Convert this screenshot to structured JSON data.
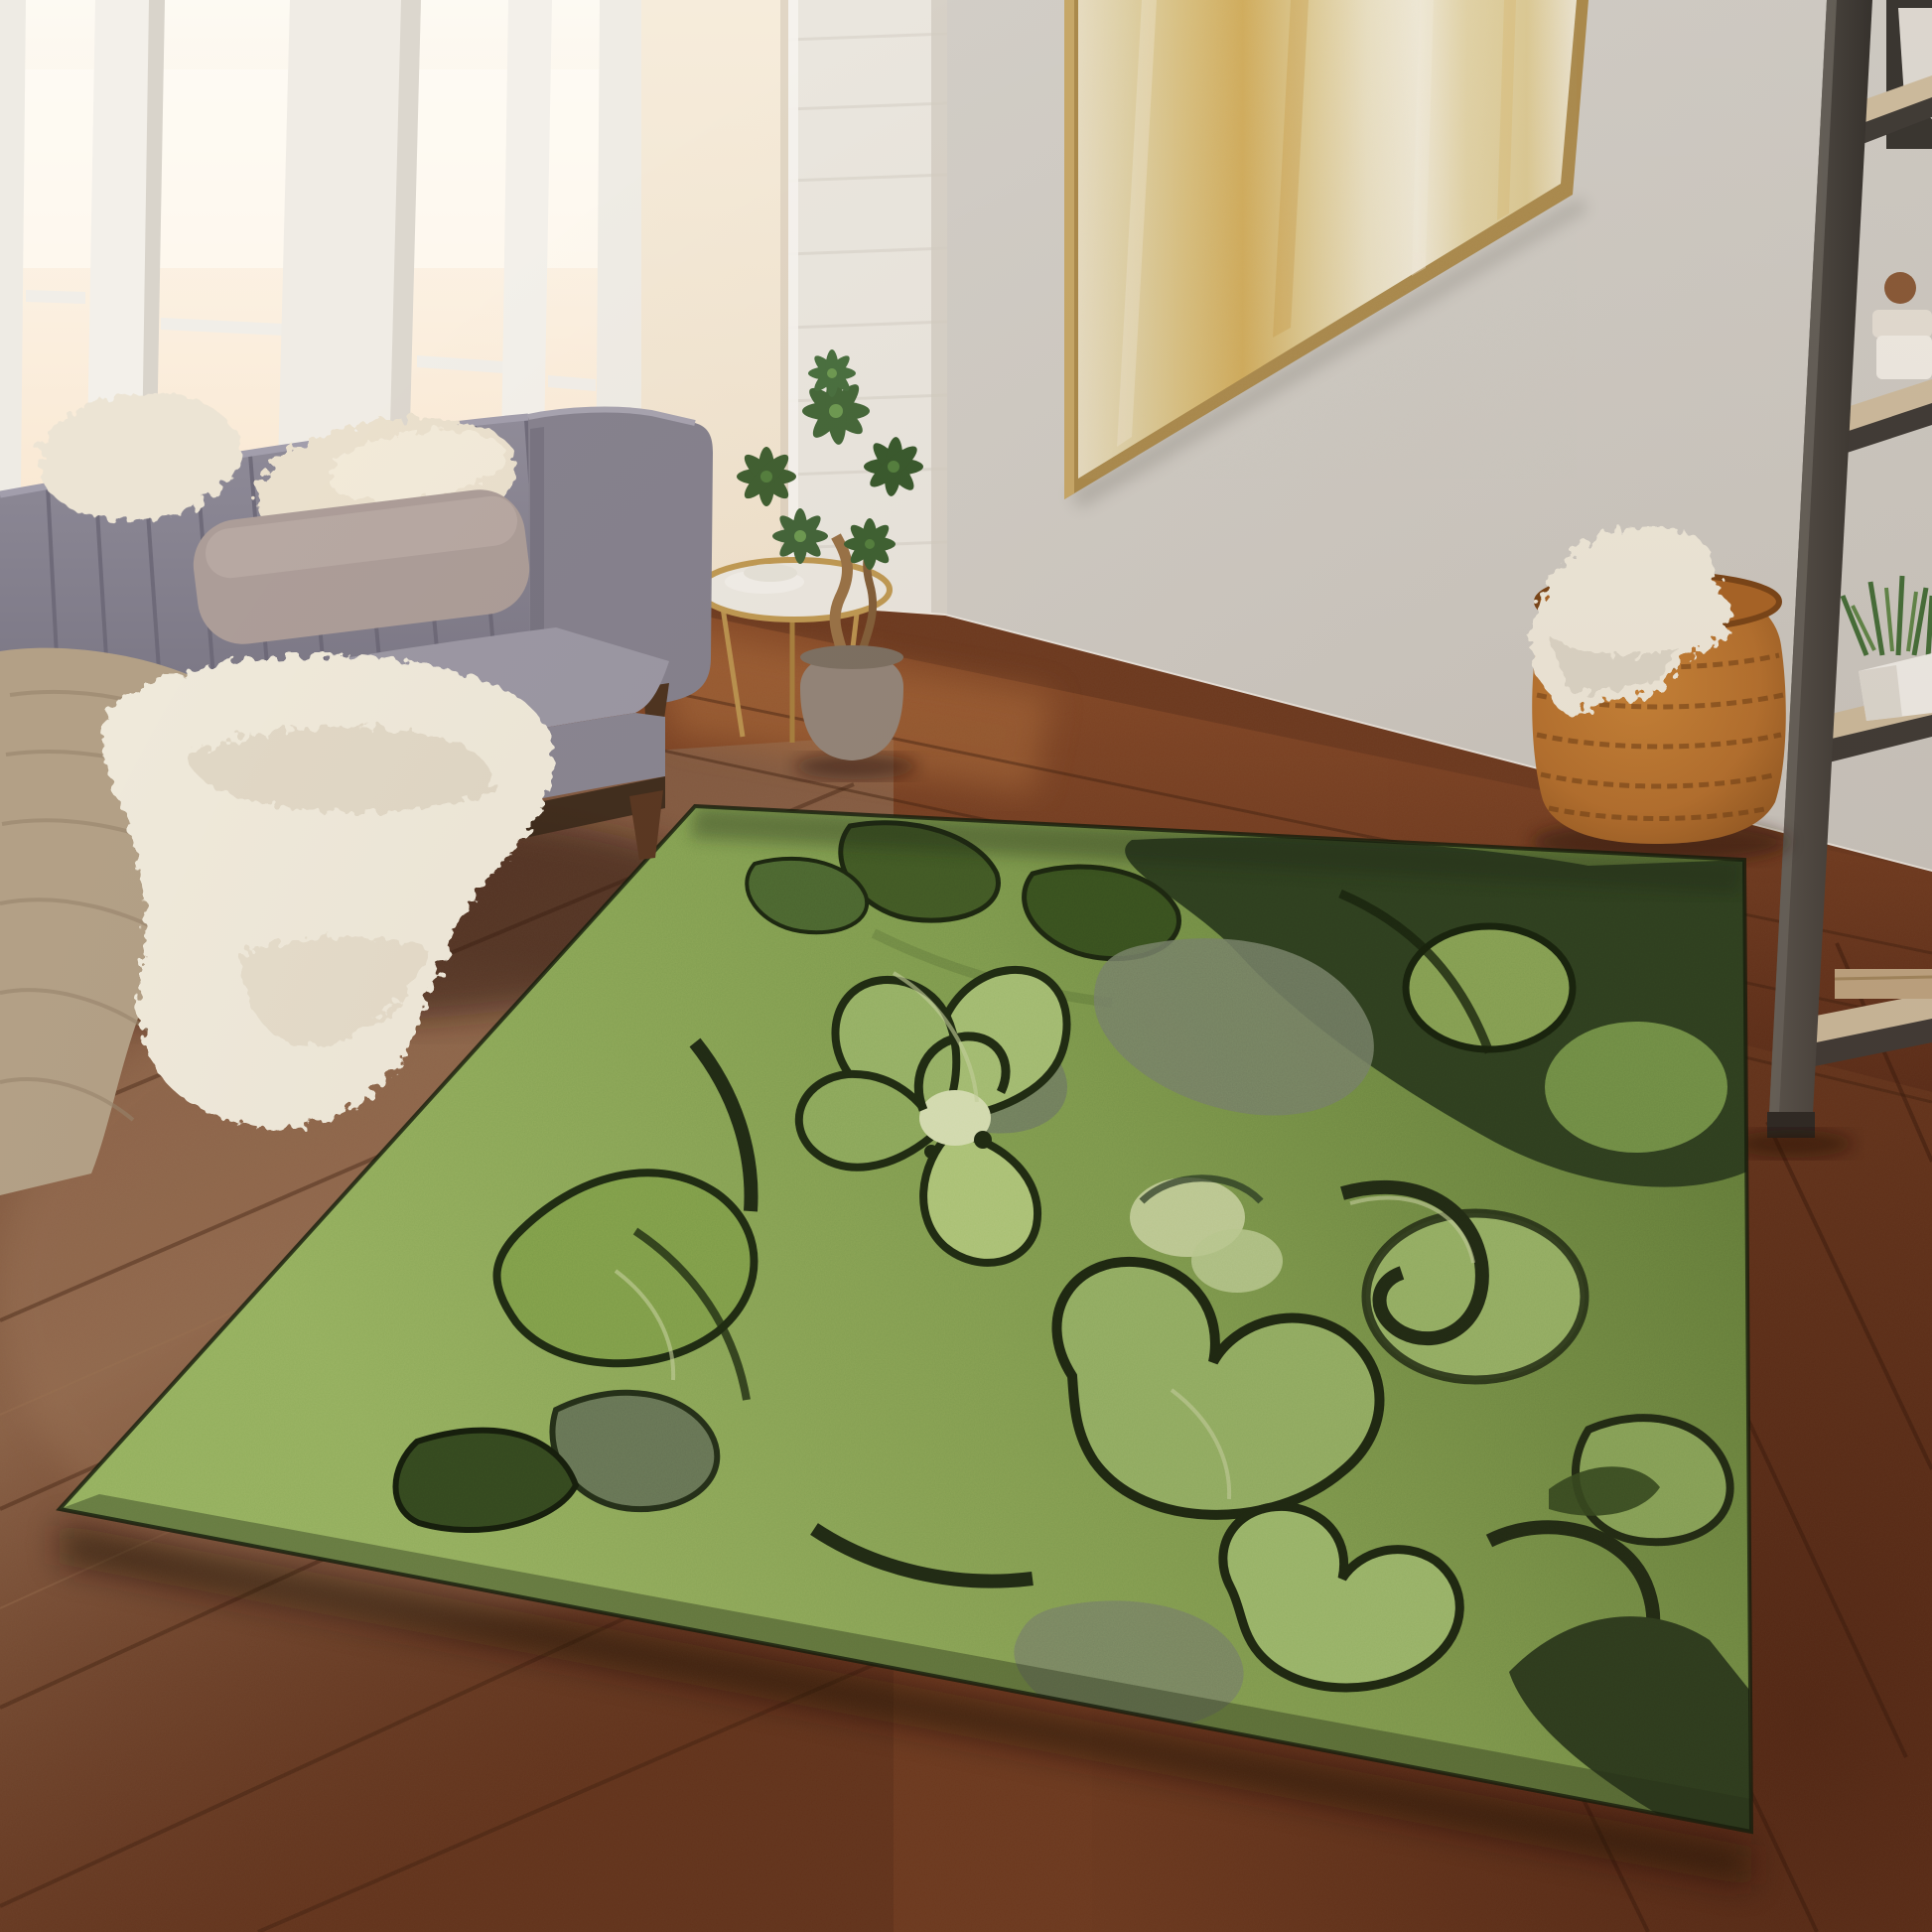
{
  "scene": {
    "type": "lifestyle-photo",
    "subject": "green abstract floral area rug",
    "room": "living room corner with window light",
    "objects": [
      "area-rug",
      "sofa",
      "fur-pillow",
      "mauve-lumbar-pillow",
      "white-fur-throw",
      "tan-knit-throw",
      "side-table",
      "potted-plant",
      "white-brick-column",
      "window-wall",
      "abstract-painting",
      "ladder-shelf",
      "shelf-plant",
      "shelf-linens",
      "shelf-plate",
      "woven-pouf",
      "pouf-throw",
      "hardwood-floor",
      "baseboard"
    ]
  },
  "palette": {
    "wall": "#d6d2cb",
    "wall_shadow": "#c6c1b9",
    "glass_top": "#fdfaf3",
    "glass_bottom": "#f6dfc2",
    "post_white": "#f3f0ea",
    "column_white": "#eae6de",
    "hall_cream": "#f3e7d4",
    "frame_gold": "#ab8a4c",
    "canvas_cream": "#e8ddc1",
    "canvas_gold": "#d2ad5c",
    "sofa_gray": "#86828e",
    "sofa_gray_light": "#9c98a4",
    "sofa_base_dark": "#3c2a1b",
    "pillow_fur": "#eae0cd",
    "pillow_mauve": "#ac9d98",
    "throw_white": "#efe9da",
    "throw_tan": "#b3a086",
    "leg_wood": "#5a3822",
    "plant_green": "#416032",
    "pot_taupe": "#94867a",
    "table_gold": "#c09a54",
    "shelf_dark": "#4a453f",
    "shelf_oak": "#cdbb9d",
    "basket_rust": "#b5712f",
    "basket_dark": "#6e3f16",
    "floor_base": "#6e3a1f",
    "floor_dark": "#4a2110",
    "floor_light": "#8a6146",
    "rug_dark_corner": "#2c3f1f",
    "rug_base_mid": "#7d9c4e",
    "rug_base_light": "#93b05e",
    "rug_sage": "#a4c072",
    "rug_outline": "#1d2a12",
    "rug_gray": "#76816a",
    "baseboard": "#e9e4dc"
  }
}
